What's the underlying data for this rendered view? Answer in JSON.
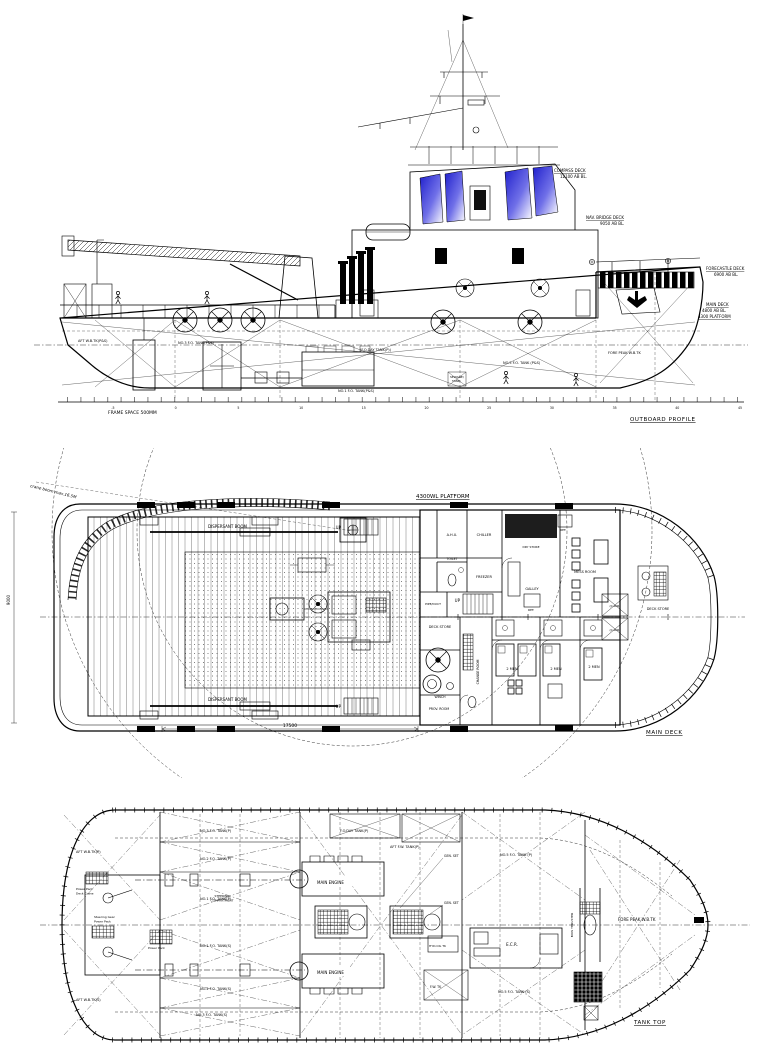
{
  "colors": {
    "window_blue": "#2020cc"
  },
  "profile": {
    "title": "OUTBOARD PROFILE",
    "frame_note": "FRAME SPACE 500MM",
    "decks": {
      "compass": {
        "name": "COMPASS DECK",
        "elev": "12100 AB BL."
      },
      "bridge": {
        "name": "NAV. BRIDGE DECK",
        "elev": "9050 AB BL."
      },
      "forecastle": {
        "name": "FORECASTLE DECK",
        "elev": "6900 AB BL."
      },
      "main": {
        "name": "MAIN DECK",
        "elev": "4800 AB BL.",
        "extra": "4300 PLATFORM"
      }
    },
    "tanks": {
      "aft_wb": "AFT W.B.TK(P&S)",
      "no3_fo": "NO.3 F.O. TANK(P&S)",
      "fo_day": "(F.O.DAY TANK(P))",
      "no1_fo": "NO.1 F.O. TANK(P&S)",
      "no5_fo": "NO.5 F.O. TANK (P&S)",
      "sewage_1": "SEWAGE/",
      "sewage_2": "TANK",
      "fore_peak": "FORE PEAK W.B.TK"
    },
    "frame_numbers": [
      "-5",
      "0",
      "5",
      "10",
      "15",
      "20",
      "25",
      "30",
      "35",
      "40",
      "45"
    ]
  },
  "main_deck": {
    "title": "MAIN DECK",
    "platform_label": "4300WL PLATFORM",
    "crane_note": "crane boom max.16.5M",
    "dispersant_boom": "DISPERSANT BOOM",
    "up": "UP",
    "dim_length": "17500",
    "dim_width": "9000",
    "rooms": {
      "ahu": "A.H.U.",
      "chiller": "CHILLER",
      "dry_store": "DRY STORE",
      "freezer": "FREEZER",
      "galley": "GALLEY",
      "ref": "REF.",
      "mess": "MESS ROOM",
      "toilet": "TOILET",
      "pipe_duct": "PIPE/DUCT",
      "deck_store": "DECK STORE",
      "change_room": "CHANGE ROOM",
      "cabin_2men": "2 MEN",
      "prov_room": "PROV. ROOM",
      "winch": "WINCH",
      "chain_locker": "(C.LKR)"
    }
  },
  "tank_top": {
    "title": "TANK TOP",
    "labels": {
      "aft_wb_p": "AFT W.B.TK(P)",
      "aft_wb_s": "AFT W.B.TK(S)",
      "no3_fo_p": "NO.3 F.O. TANK(P)",
      "no2_fo_p": "NO.2 F.O. TANK(P)",
      "no1_fo_p": "NO.1 F.O. TANK(P)",
      "no1_fo_s": "NO.1 F.O. TANK(S)",
      "no2_fo_s": "NO.2 F.O. TANK(S)",
      "no3_fo_s": "NO.3 F.O. TANK(S)",
      "no5_fo_p": "NO.5 F.O. TANK (P)",
      "no5_fo_s": "NO.5 F.O. TANK (S)",
      "fo_day_p": "F.O.DAY TANK(P)",
      "aft_fw_p": "AFT F.W. TANK(P)",
      "fw_tk": "F.W. TK",
      "hyd_oil": "HYD.OIL TK",
      "steering_1": "STEERING",
      "steering_2": "COMPARTMENT",
      "pp_crane_1": "Power Pack",
      "pp_crane_2": "Deck Crane",
      "sg_pp_1": "Steering Gear",
      "sg_pp_2": "Power Pack",
      "power_pack": "Power Pack",
      "main_engine": "MAIN ENGINE",
      "gen_set": "GEN. SET",
      "ecr": "E.C.R.",
      "bow_thruster": "BOW THRUSTER",
      "fore_peak": "FORE PEAK W.B.TK"
    }
  }
}
